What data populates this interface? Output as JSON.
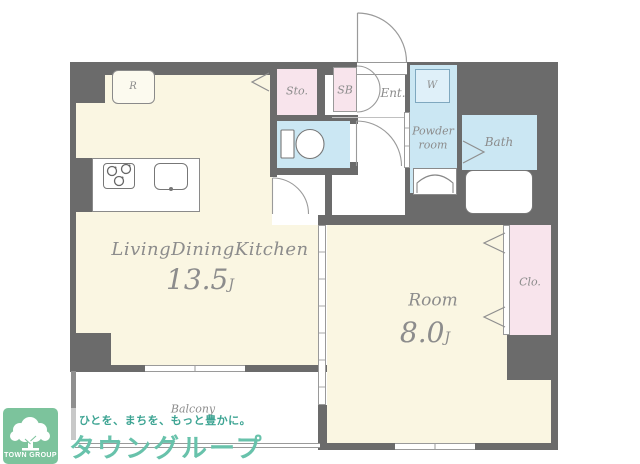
{
  "plan": {
    "ldk": {
      "label": "LivingDiningKitchen",
      "size": "13.5",
      "unit": "J"
    },
    "room": {
      "label": "Room",
      "size": "8.0",
      "unit": "J"
    },
    "balcony_label": "Balcony",
    "entrance_label": "Ent.",
    "storage_label": "Sto.",
    "shoebox_label": "SB",
    "washer_label": "W",
    "powder_line1": "Powder",
    "powder_line2": "room",
    "bath_label": "Bath",
    "closet_label": "Clo.",
    "fridge_label": "R",
    "colors": {
      "wall": "#6B6B6B",
      "floor": "#FAF6E2",
      "wet_area": "#CBE7F3",
      "storage_area": "#F8E4EC",
      "label_text": "#8C8C8C"
    }
  },
  "branding": {
    "logo_text": "TOWN GROUP",
    "tagline": "ひとを、まちを、もっと豊かに。",
    "company": "タウングループ",
    "colors": {
      "logo_box": "#7CC39C",
      "tagline": "#3DA493",
      "company": "#68C2AB"
    }
  }
}
